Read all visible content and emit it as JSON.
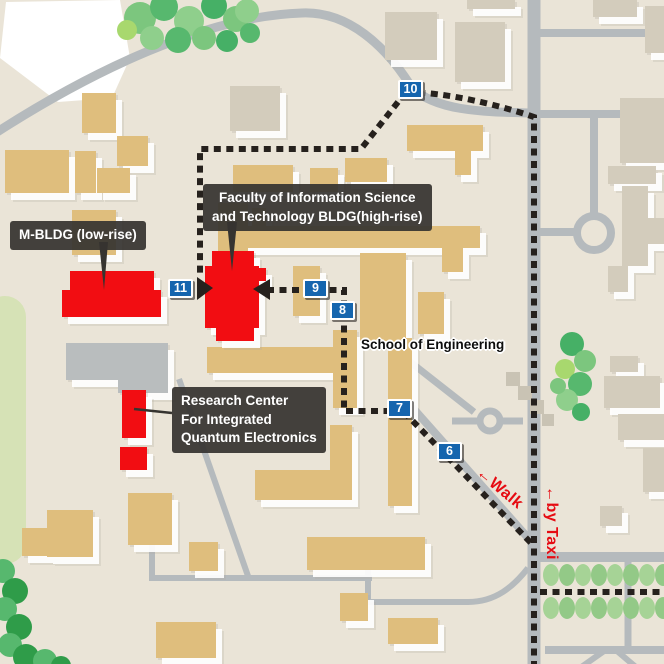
{
  "map": {
    "width": 664,
    "height": 664,
    "colors": {
      "bg": "#eae4d7",
      "road": "#b5babd",
      "tan": "#dfbe7d",
      "gray_bldg": "#d3ccbc",
      "roadgray": "#b9bdbe",
      "steps": "#c9c3b4",
      "red": "#f20d12",
      "dash": "#26211d",
      "badge_blue": "#1565ae",
      "label_bg": "#363430",
      "accent_red": "#e60b12",
      "field": "#ffffff",
      "pale_green": "#d6e2b6",
      "tree_palette": [
        "#7cc67e",
        "#57b86e",
        "#8fcf8c",
        "#46b066",
        "#a8d86e",
        "#2f9c49"
      ],
      "hedge_palette": [
        "#a6d396",
        "#93c987"
      ]
    },
    "callouts": {
      "m_bldg": {
        "text": "M-BLDG (low-rise)",
        "x": 10,
        "y": 221
      },
      "faculty": {
        "lines": [
          "Faculty of Information Science",
          "and Technology BLDG(high-rise)"
        ],
        "x": 203,
        "y": 184
      },
      "research": {
        "lines": [
          "Research Center",
          "For Integrated",
          "Quantum Electronics"
        ],
        "x": 172,
        "y": 387
      }
    },
    "area_label": {
      "text": "School of Engineering",
      "x": 361,
      "y": 337
    },
    "route_labels": {
      "walk": {
        "text": "←Walk",
        "x": 484,
        "y": 464,
        "angle": 40
      },
      "taxi": {
        "text": "←by Taxi",
        "x": 560,
        "y": 486,
        "angle": 90
      }
    },
    "waypoints": [
      {
        "n": "10",
        "x": 398,
        "y": 80
      },
      {
        "n": "11",
        "x": 168,
        "y": 279
      },
      {
        "n": "9",
        "x": 303,
        "y": 279
      },
      {
        "n": "8",
        "x": 330,
        "y": 301
      },
      {
        "n": "7",
        "x": 387,
        "y": 399
      },
      {
        "n": "6",
        "x": 437,
        "y": 442
      }
    ],
    "buildings": {
      "tan": [
        [
          82,
          93,
          34,
          40
        ],
        [
          117,
          136,
          31,
          30
        ],
        [
          5,
          150,
          64,
          43
        ],
        [
          75,
          151,
          21,
          42
        ],
        [
          97,
          168,
          33,
          25
        ],
        [
          72,
          210,
          44,
          45
        ],
        [
          218,
          203,
          30,
          52
        ],
        [
          252,
          208,
          14,
          38
        ],
        [
          233,
          165,
          60,
          27
        ],
        [
          310,
          168,
          28,
          24
        ],
        [
          345,
          158,
          42,
          24
        ],
        [
          407,
          125,
          76,
          26
        ],
        [
          455,
          151,
          16,
          24
        ],
        [
          230,
          226,
          250,
          22
        ],
        [
          293,
          266,
          27,
          50
        ],
        [
          360,
          253,
          46,
          88
        ],
        [
          418,
          292,
          26,
          42
        ],
        [
          207,
          347,
          126,
          26
        ],
        [
          333,
          330,
          24,
          78
        ],
        [
          388,
          338,
          24,
          168
        ],
        [
          330,
          425,
          22,
          58
        ],
        [
          255,
          470,
          97,
          30
        ],
        [
          307,
          537,
          118,
          33
        ],
        [
          128,
          493,
          44,
          52
        ],
        [
          47,
          510,
          46,
          47
        ],
        [
          189,
          542,
          29,
          29
        ],
        [
          340,
          593,
          28,
          28
        ],
        [
          388,
          618,
          50,
          26
        ],
        [
          156,
          622,
          60,
          36
        ],
        [
          22,
          528,
          32,
          28
        ],
        [
          442,
          237,
          21,
          35
        ]
      ],
      "gray": [
        [
          230,
          86,
          50,
          45
        ],
        [
          385,
          12,
          52,
          48
        ],
        [
          455,
          22,
          50,
          60
        ],
        [
          467,
          0,
          48,
          9
        ],
        [
          593,
          0,
          44,
          17
        ],
        [
          645,
          6,
          19,
          47
        ],
        [
          620,
          98,
          44,
          65
        ],
        [
          608,
          166,
          48,
          18
        ],
        [
          622,
          186,
          26,
          80
        ],
        [
          648,
          218,
          16,
          26
        ],
        [
          608,
          266,
          20,
          26
        ],
        [
          610,
          356,
          28,
          16
        ],
        [
          604,
          376,
          56,
          32
        ],
        [
          618,
          414,
          46,
          26
        ],
        [
          643,
          448,
          21,
          44
        ],
        [
          600,
          506,
          22,
          20
        ],
        [
          66,
          343,
          102,
          37,
          "roadgray"
        ],
        [
          118,
          365,
          50,
          28,
          "roadgray"
        ]
      ],
      "flat_gray": [
        [
          506,
          372,
          14,
          14
        ],
        [
          518,
          386,
          14,
          14
        ],
        [
          530,
          400,
          14,
          14
        ],
        [
          542,
          414,
          12,
          12
        ]
      ],
      "red_groups": [
        {
          "name": "faculty-highrise",
          "rects": [
            [
              212,
              251,
              42,
              17
            ],
            [
              205,
              266,
              54,
              62
            ],
            [
              255,
              268,
              11,
              13
            ],
            [
              216,
              326,
              38,
              15
            ]
          ]
        },
        {
          "name": "m-bldg-lowrise",
          "rects": [
            [
              70,
              271,
              84,
              23
            ],
            [
              62,
              290,
              99,
              27
            ]
          ]
        },
        {
          "name": "research-center",
          "rects": [
            [
              122,
              390,
              24,
              48
            ],
            [
              120,
              447,
              27,
              23
            ]
          ]
        }
      ]
    },
    "roads": [
      {
        "d": "M534,-4 L534,668",
        "w": 13
      },
      {
        "d": "M-6,134 C90,72 205,16 302,13 C348,11 386,46 412,88 C436,110 478,112 530,113",
        "w": 9
      },
      {
        "d": "M540,33 L668,33",
        "w": 8
      },
      {
        "d": "M540,114 L622,114",
        "w": 8
      },
      {
        "d": "M594,114 L594,213",
        "w": 8
      },
      {
        "c": [
          594,
          233,
          17
        ],
        "w": 8
      },
      {
        "d": "M540,232 L577,232",
        "w": 8
      },
      {
        "d": "M534,557 L668,557",
        "w": 10
      },
      {
        "d": "M545,650 L668,650",
        "w": 8
      },
      {
        "d": "M628,561 L628,648",
        "w": 7
      },
      {
        "d": "M604,651 L580,668",
        "w": 6
      },
      {
        "d": "M617,651 L637,668",
        "w": 6
      },
      {
        "c": [
          490,
          421,
          10
        ],
        "w": 7
      },
      {
        "d": "M452,421 L480,421",
        "w": 7
      },
      {
        "d": "M500,421 L523,421",
        "w": 7
      },
      {
        "d": "M409,361 L474,412",
        "w": 7
      },
      {
        "d": "M412,407 L537,548",
        "w": 8
      },
      {
        "d": "M152,537 L152,579",
        "w": 6
      },
      {
        "d": "M149,578 L372,578",
        "w": 6
      },
      {
        "d": "M179,379 L248,576",
        "w": 6
      },
      {
        "d": "M368,567 L368,603",
        "w": 6
      },
      {
        "d": "M366,602 L468,602 C496,602 514,586 528,568",
        "w": 6
      }
    ],
    "route": {
      "dashes": [
        "M534,668 L534,117 C505,107 462,96 425,93",
        "M398,102 L361,149 L200,149 L200,277",
        "M267,290 L344,290 L344,411 L389,411",
        "M404,412 L531,543",
        "M540,592 L668,592"
      ],
      "arrows": [
        "197,277 197,300 213,288",
        "270,279 270,300 253,289"
      ],
      "pointer_triangles": [
        "99,242 108,242 104,290",
        "227,222 237,222 232,271"
      ],
      "pointer_lines": [
        {
          "d": "M172,413 L134,409",
          "w": 2.5
        }
      ]
    },
    "trees": {
      "top_left": [
        [
          140,
          18,
          16,
          0
        ],
        [
          164,
          7,
          14,
          1
        ],
        [
          189,
          21,
          15,
          2
        ],
        [
          214,
          6,
          13,
          3
        ],
        [
          236,
          19,
          13,
          0
        ],
        [
          152,
          38,
          12,
          2
        ],
        [
          178,
          40,
          13,
          1
        ],
        [
          204,
          38,
          12,
          0
        ],
        [
          227,
          41,
          11,
          3
        ],
        [
          247,
          11,
          12,
          2
        ],
        [
          250,
          33,
          10,
          1
        ],
        [
          127,
          30,
          10,
          4
        ]
      ],
      "right_mid": [
        [
          572,
          344,
          12,
          3
        ],
        [
          585,
          361,
          11,
          0
        ],
        [
          565,
          369,
          10,
          4
        ],
        [
          580,
          384,
          12,
          1
        ],
        [
          567,
          400,
          11,
          2
        ],
        [
          581,
          412,
          9,
          3
        ],
        [
          558,
          386,
          8,
          0
        ]
      ],
      "bottom_left": [
        [
          3,
          571,
          12,
          1
        ],
        [
          15,
          591,
          13,
          5
        ],
        [
          5,
          609,
          12,
          1
        ],
        [
          19,
          627,
          13,
          5
        ],
        [
          10,
          645,
          12,
          1
        ],
        [
          26,
          657,
          13,
          5
        ],
        [
          45,
          661,
          12,
          1
        ],
        [
          61,
          666,
          10,
          5
        ]
      ]
    },
    "hedges": {
      "rows_y": [
        575,
        608
      ],
      "x0": 551,
      "step": 16,
      "count": 8,
      "rx": 8,
      "ry": 11
    }
  }
}
